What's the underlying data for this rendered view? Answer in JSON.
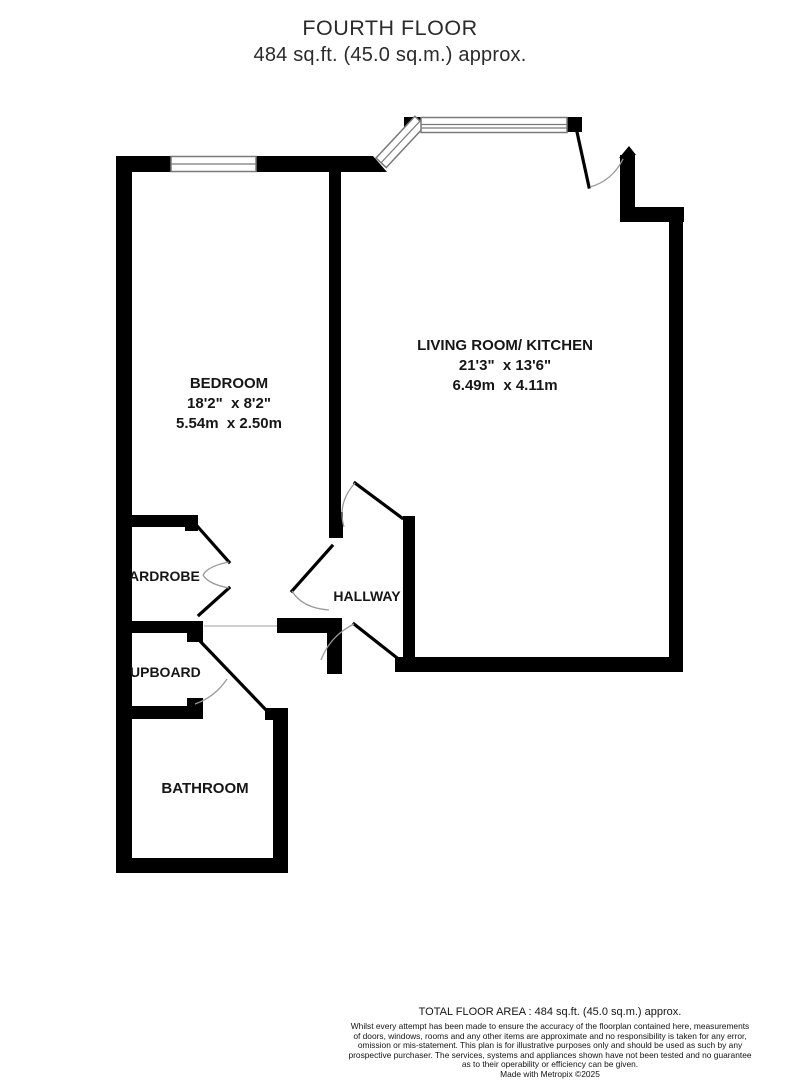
{
  "header": {
    "title": "FOURTH FLOOR",
    "subtitle": "484 sq.ft. (45.0 sq.m.) approx."
  },
  "rooms": {
    "living": {
      "name": "LIVING ROOM/ KITCHEN",
      "dims_imperial": "21'3\"  x 13'6\"",
      "dims_metric": "6.49m  x 4.11m"
    },
    "bedroom": {
      "name": "BEDROOM",
      "dims_imperial": "18'2\"  x 8'2\"",
      "dims_metric": "5.54m  x 2.50m"
    },
    "hallway": {
      "name": "HALLWAY"
    },
    "wardrobe": {
      "name": "ARDROBE"
    },
    "cupboard": {
      "name": "UPBOARD"
    },
    "bathroom": {
      "name": "BATHROOM"
    }
  },
  "footer": {
    "total_area": "TOTAL FLOOR AREA : 484 sq.ft. (45.0 sq.m.) approx.",
    "disclaimer_lines": [
      "Whilst every attempt has been made to ensure the accuracy of the floorplan contained here, measurements",
      "of doors, windows, rooms and any other items are approximate and no responsibility is taken for any error,",
      "omission or mis-statement. This plan is for illustrative purposes only and should be used as such by any",
      "prospective purchaser. The services, systems and appliances shown have not been tested and no guarantee",
      "as to their operability or efficiency can be given."
    ],
    "credit": "Made with Metropix ©2025"
  },
  "colors": {
    "wall": "#000000",
    "background": "#ffffff",
    "door_arc": "#9a9a9a",
    "text": "#161616"
  }
}
